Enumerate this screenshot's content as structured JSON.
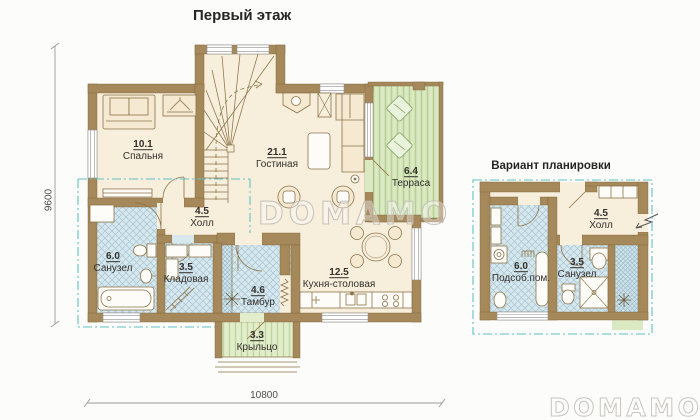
{
  "title": "Первый этаж",
  "variant_title": "Вариант планировки",
  "watermark": "DOMAMO",
  "dimensions": {
    "horizontal": "10800",
    "vertical": "9600"
  },
  "main_plan": {
    "rooms": [
      {
        "area": "10.1",
        "name": "Спальня"
      },
      {
        "area": "21.1",
        "name": "Гостиная"
      },
      {
        "area": "6.4",
        "name": "Терраса"
      },
      {
        "area": "4.5",
        "name": "Холл"
      },
      {
        "area": "6.0",
        "name": "Санузел"
      },
      {
        "area": "3.5",
        "name": "Кладовая"
      },
      {
        "area": "4.6",
        "name": "Тамбур"
      },
      {
        "area": "12.5",
        "name": "Кухня-столовая"
      },
      {
        "area": "3.3",
        "name": "Крыльцо"
      }
    ]
  },
  "variant_plan": {
    "rooms": [
      {
        "area": "4.5",
        "name": "Холл"
      },
      {
        "area": "6.0",
        "name": "Подсоб.пом."
      },
      {
        "area": "3.5",
        "name": "Санузел"
      }
    ]
  },
  "colors": {
    "wall": "#a6895a",
    "floor": "#f7eedb",
    "tile": "#d6e7ee",
    "terrace_green": "#dbe9c2",
    "overhang_teal": "#5fc2c4"
  }
}
